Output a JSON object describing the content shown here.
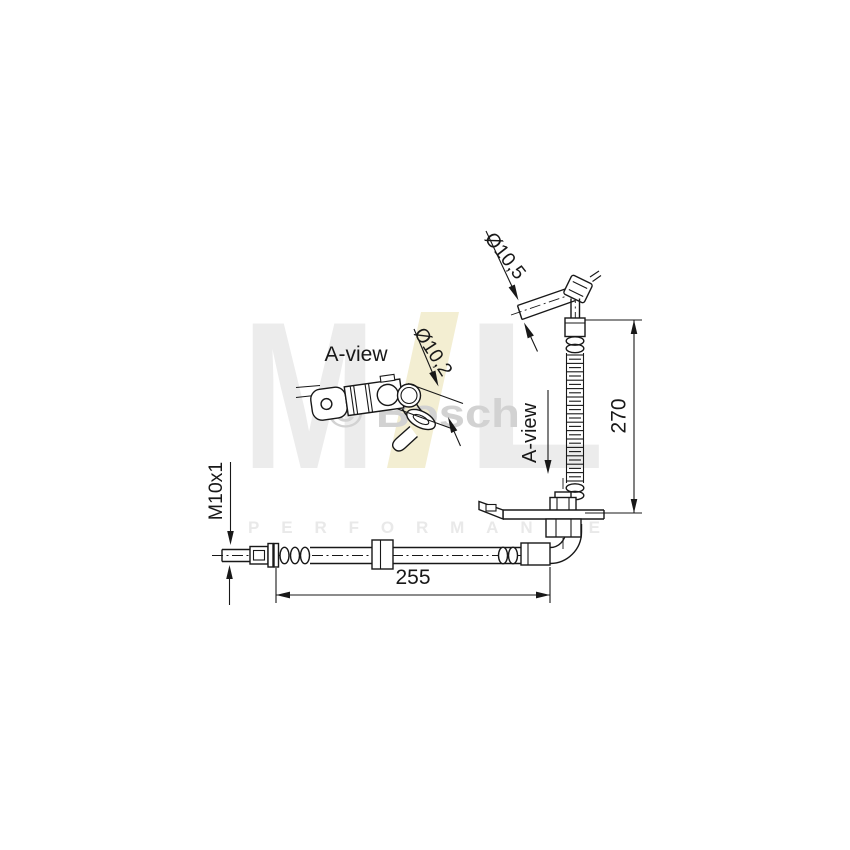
{
  "watermark": {
    "logo": {
      "m": "M",
      "l": "L",
      "m_color": "#ececec",
      "l_color": "#ececec",
      "slash_color": "#f3eed2"
    },
    "performance_text": "PERFORMANCE",
    "performance_color": "#e9e9e9",
    "bosch_text": "© Bosch",
    "bosch_color": "#d2d2d2"
  },
  "drawing": {
    "ink_color": "#181818",
    "labels": {
      "a_view_title": "A-view",
      "a_view_pointer": "A-view",
      "dia_banjo_bolt": "Ø10,5",
      "dia_hose_end": "Ø10,2",
      "thread_size": "M10x1",
      "length_vertical_mm": "270",
      "length_horizontal_mm": "255"
    }
  }
}
